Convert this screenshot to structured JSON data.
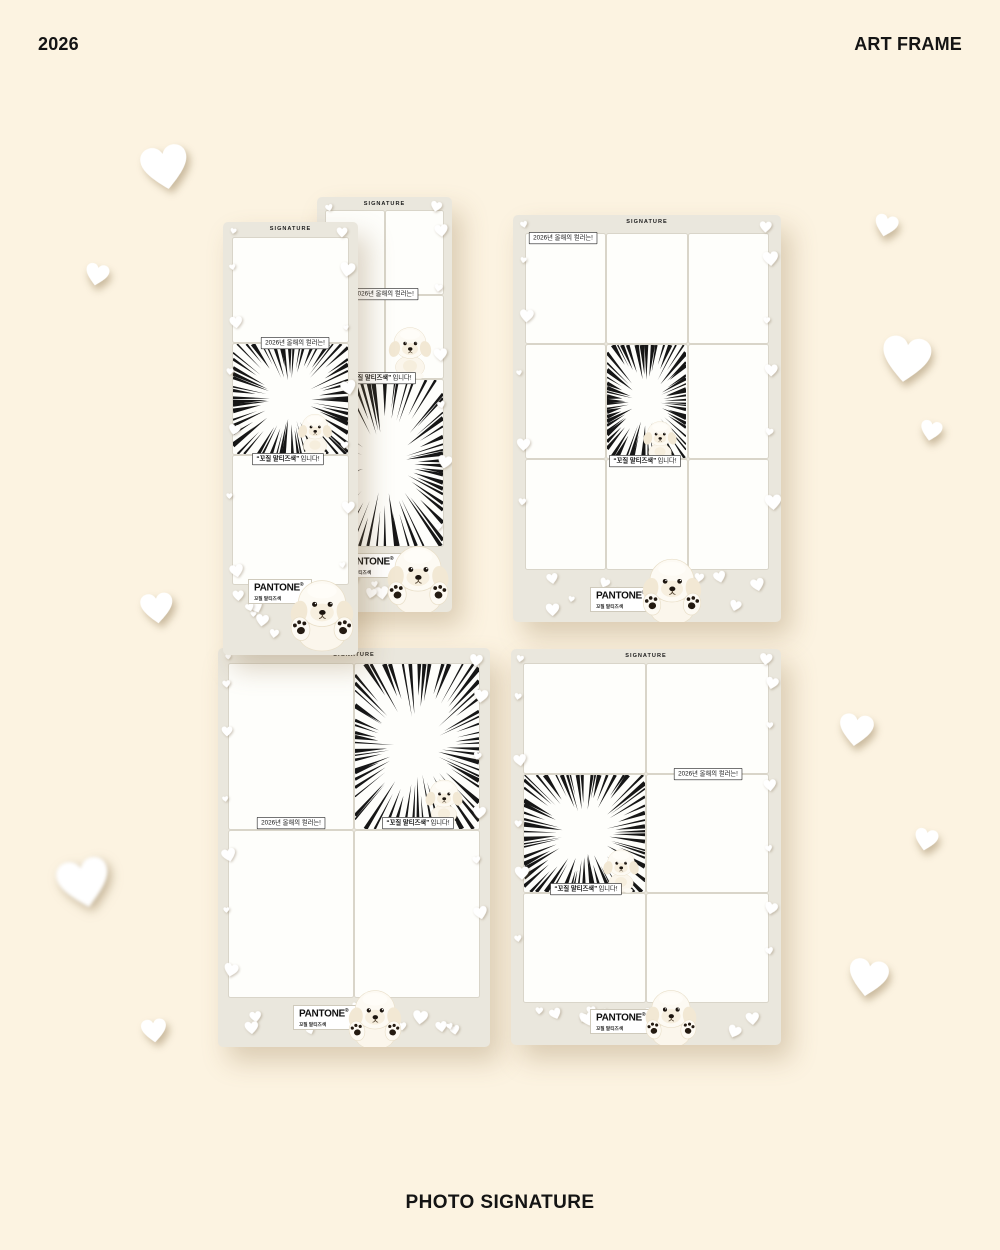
{
  "page": {
    "title_left": "2026",
    "title_right": "ART FRAME",
    "footer_title": "PHOTO SIGNATURE",
    "background_color": "#fcf3e1"
  },
  "labels": {
    "signature": "SIGNATURE",
    "color_intro": "2026년 올해의 컬러는!",
    "color_name_quoted": "“꼬질 말티즈색”",
    "color_suffix": "입니다!",
    "pantone_brand": "PANTONE",
    "pantone_mark": "®",
    "pantone_color_name": "꼬질 말티즈색"
  },
  "frames": [
    {
      "name": "tall-photo-strip-back",
      "header": "SIGNATURE",
      "photo_slots": 4,
      "effect_slots": 1
    },
    {
      "name": "tall-photo-strip-front",
      "header": "SIGNATURE",
      "photo_slots": 2,
      "effect_slots": 1
    },
    {
      "name": "grid-3x3",
      "header": "SIGNATURE",
      "photo_slots": 8,
      "effect_slots": 1
    },
    {
      "name": "grid-2x2",
      "header": "SIGNATURE",
      "photo_slots": 3,
      "effect_slots": 1
    },
    {
      "name": "grid-2x3",
      "header": "SIGNATURE",
      "photo_slots": 5,
      "effect_slots": 1
    }
  ],
  "colors": {
    "frame": "#eae7dd",
    "cell": "#fefefb",
    "divider": "#d9d5c9",
    "text": "#141414",
    "tag_border": "#222222"
  }
}
